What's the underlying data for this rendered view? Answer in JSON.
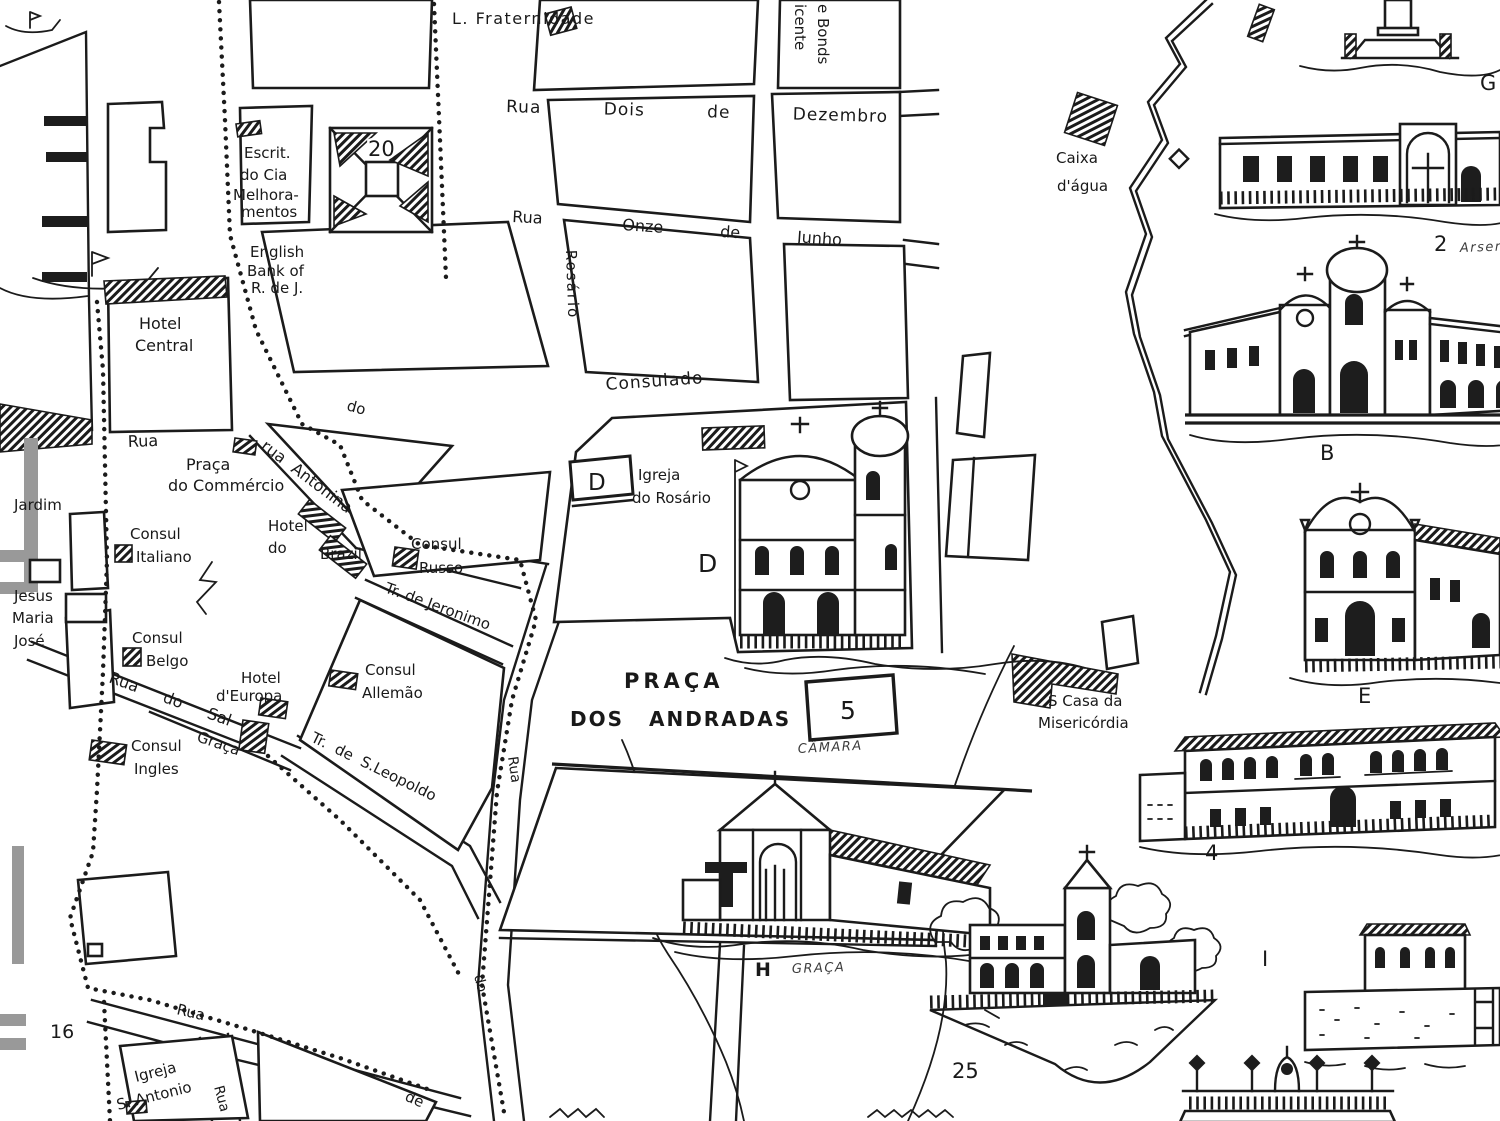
{
  "map": {
    "title": "Hand-drawn historic city map with street grid, waterfront piers, tram lines, river and building sketches",
    "ink_color": "#1b1b1b",
    "paper_color": "#ffffff",
    "streets": {
      "dois_de_dezembro": "Rua Dois de Dezembro",
      "onze_rua": "Rua",
      "onze_de_junho": "Onze de Junho",
      "rosario": "Rosário",
      "consulado": "Consulado",
      "commercio_rua": "Rua",
      "antonina": "rua Antonina",
      "do_upper": "do",
      "do_sal": "Rua do Sal",
      "graca": "Graça",
      "jeronimo": "Tr. de Jeronimo",
      "leopoldo": "Tr. de S.Leopoldo",
      "rua_mid_vertical": "Rua",
      "do_mid_vertical": "do",
      "rua_bottom": "Rua",
      "de_bottom": "de",
      "rua_bottom_vertical": "Rua",
      "e_bonds": "e Bonds",
      "vicente": "icente"
    },
    "places": {
      "l_fraternidade": "L. Fraternidade",
      "escritorio": [
        "Escrit.",
        "do Cia",
        "Melhora-",
        "mentos"
      ],
      "english_bank": [
        "English",
        "Bank of",
        "R. de J."
      ],
      "hotel_central": [
        "Hotel",
        "Central"
      ],
      "praca_do_commercio": [
        "Praça",
        "do Commércio"
      ],
      "jardim": "Jardim",
      "consul_italiano": [
        "Consul",
        "Italiano"
      ],
      "jesus_maria_jose": [
        "Jesus",
        "Maria",
        "José"
      ],
      "consul_belgo": [
        "Consul",
        "Belgo"
      ],
      "hotel_do_brazil": [
        "Hotel",
        "do",
        "Brazil"
      ],
      "consul_russo": [
        "Consul",
        "Russo"
      ],
      "consul_allemao": [
        "Consul",
        "Allemão"
      ],
      "hotel_d_europa": [
        "Hotel",
        "d'Europa"
      ],
      "consul_ingles": [
        "Consul",
        "Ingles"
      ],
      "praca_dos_andradas": [
        "PRAÇA",
        "DOS ANDRADAS"
      ],
      "camara": "CÂMARA",
      "igreja_do_rosario": [
        "Igreja",
        "do Rosário"
      ],
      "caixa_dagua": [
        "Caixa",
        "d'água"
      ],
      "santa_casa": [
        "S  Casa da",
        "Misericórdia"
      ],
      "igreja_s_antonio": [
        "Igreja",
        "S. Antonio"
      ],
      "graca_hill": "GRAÇA",
      "arsenal": "Arsenal"
    },
    "markers": {
      "n20": "20",
      "n5": "5",
      "d_box": "D",
      "d_area": "D",
      "h_area": "H",
      "g": "G",
      "b": "B",
      "e": "E",
      "n2": "2",
      "n4": "4",
      "n25": "25",
      "i": "I",
      "n16": "16"
    }
  }
}
